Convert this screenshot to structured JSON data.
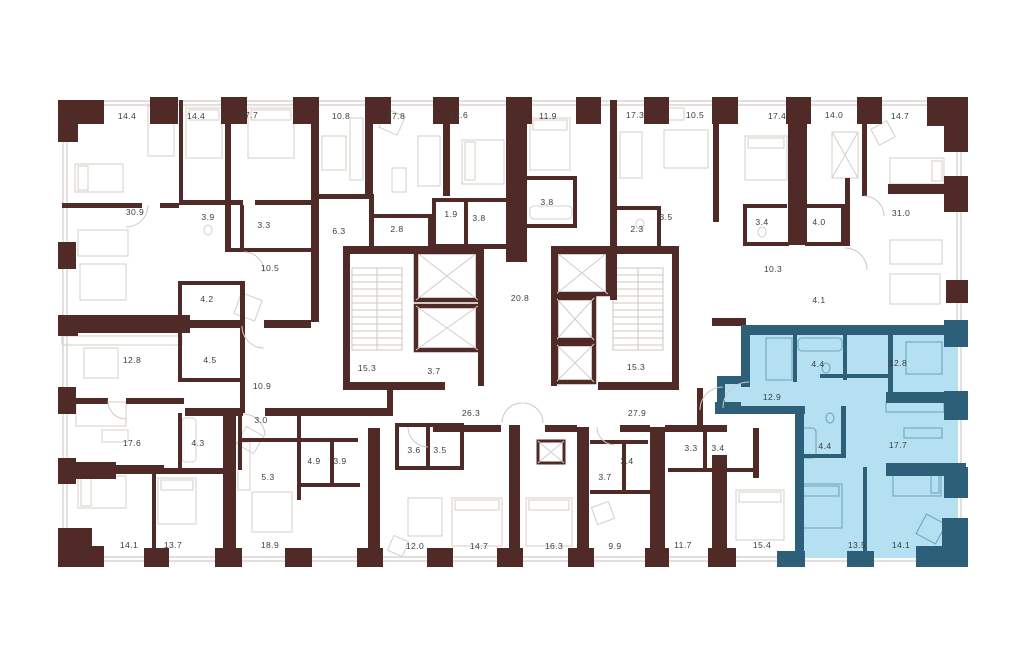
{
  "floorplan": {
    "type": "residential-building-floor-plan",
    "highlighted_unit_selected": true,
    "colors": {
      "wall": "#4f2a27",
      "teal": "#2e5f79",
      "bluefill": "#b5e0f2",
      "line": "#d9d2cb",
      "winline": "#d3ccc6",
      "bline": "#6fa6bf",
      "label": "#3d3d3d",
      "bg": "#ffffff"
    },
    "highlight_room_areas": [
      "12.9",
      "4.4",
      "12.8",
      "4.4",
      "17.7",
      "13.5",
      "14.1"
    ],
    "labels": [
      {
        "t": "14.4",
        "x": 127,
        "y": 119,
        "hl": false
      },
      {
        "t": "14.4",
        "x": 196,
        "y": 119,
        "hl": false
      },
      {
        "t": "17.7",
        "x": 249,
        "y": 118,
        "hl": false
      },
      {
        "t": "10.8",
        "x": 341,
        "y": 119,
        "hl": false
      },
      {
        "t": "17.8",
        "x": 396,
        "y": 119,
        "hl": false
      },
      {
        "t": "12.6",
        "x": 459,
        "y": 118,
        "hl": false
      },
      {
        "t": "11.9",
        "x": 548,
        "y": 119,
        "hl": false
      },
      {
        "t": "17.3",
        "x": 635,
        "y": 118,
        "hl": false
      },
      {
        "t": "10.5",
        "x": 695,
        "y": 118,
        "hl": false
      },
      {
        "t": "17.4",
        "x": 777,
        "y": 119,
        "hl": false
      },
      {
        "t": "14.0",
        "x": 834,
        "y": 118,
        "hl": false
      },
      {
        "t": "14.7",
        "x": 900,
        "y": 119,
        "hl": false
      },
      {
        "t": "30.9",
        "x": 135,
        "y": 215,
        "hl": false
      },
      {
        "t": "3.9",
        "x": 208,
        "y": 220,
        "hl": false
      },
      {
        "t": "3.3",
        "x": 264,
        "y": 228,
        "hl": false
      },
      {
        "t": "6.3",
        "x": 339,
        "y": 234,
        "hl": false
      },
      {
        "t": "2.8",
        "x": 397,
        "y": 232,
        "hl": false
      },
      {
        "t": "1.9",
        "x": 451,
        "y": 217,
        "hl": false
      },
      {
        "t": "3.8",
        "x": 479,
        "y": 221,
        "hl": false
      },
      {
        "t": "3.8",
        "x": 547,
        "y": 205,
        "hl": false
      },
      {
        "t": "2.3",
        "x": 637,
        "y": 232,
        "hl": false
      },
      {
        "t": "3.5",
        "x": 666,
        "y": 220,
        "hl": false
      },
      {
        "t": "3.4",
        "x": 762,
        "y": 225,
        "hl": false
      },
      {
        "t": "4.0",
        "x": 819,
        "y": 225,
        "hl": false
      },
      {
        "t": "31.0",
        "x": 901,
        "y": 216,
        "hl": false
      },
      {
        "t": "10.5",
        "x": 270,
        "y": 271,
        "hl": false
      },
      {
        "t": "10.3",
        "x": 773,
        "y": 272,
        "hl": false
      },
      {
        "t": "4.2",
        "x": 207,
        "y": 302,
        "hl": false
      },
      {
        "t": "12.8",
        "x": 132,
        "y": 363,
        "hl": false
      },
      {
        "t": "4.5",
        "x": 210,
        "y": 363,
        "hl": false
      },
      {
        "t": "10.9",
        "x": 262,
        "y": 389,
        "hl": false
      },
      {
        "t": "15.3",
        "x": 367,
        "y": 371,
        "hl": false
      },
      {
        "t": "3.7",
        "x": 434,
        "y": 374,
        "hl": false
      },
      {
        "t": "20.8",
        "x": 520,
        "y": 301,
        "hl": false
      },
      {
        "t": "15.3",
        "x": 636,
        "y": 370,
        "hl": false
      },
      {
        "t": "4.1",
        "x": 819,
        "y": 303,
        "hl": false
      },
      {
        "t": "26.3",
        "x": 471,
        "y": 416,
        "hl": false
      },
      {
        "t": "27.9",
        "x": 637,
        "y": 416,
        "hl": false
      },
      {
        "t": "12.9",
        "x": 772,
        "y": 400,
        "hl": true
      },
      {
        "t": "4.4",
        "x": 818,
        "y": 367,
        "hl": true
      },
      {
        "t": "12.8",
        "x": 898,
        "y": 366,
        "hl": true
      },
      {
        "t": "4.4",
        "x": 825,
        "y": 449,
        "hl": true
      },
      {
        "t": "17.7",
        "x": 898,
        "y": 448,
        "hl": true
      },
      {
        "t": "13.5",
        "x": 857,
        "y": 548,
        "hl": true
      },
      {
        "t": "14.1",
        "x": 901,
        "y": 548,
        "hl": true
      },
      {
        "t": "17.6",
        "x": 132,
        "y": 446,
        "hl": false
      },
      {
        "t": "4.3",
        "x": 198,
        "y": 446,
        "hl": false
      },
      {
        "t": "3.0",
        "x": 261,
        "y": 423,
        "hl": false
      },
      {
        "t": "5.3",
        "x": 268,
        "y": 480,
        "hl": false
      },
      {
        "t": "4.9",
        "x": 314,
        "y": 464,
        "hl": false
      },
      {
        "t": "3.9",
        "x": 340,
        "y": 464,
        "hl": false
      },
      {
        "t": "3.6",
        "x": 414,
        "y": 453,
        "hl": false
      },
      {
        "t": "3.5",
        "x": 440,
        "y": 453,
        "hl": false
      },
      {
        "t": "3.4",
        "x": 627,
        "y": 464,
        "hl": false
      },
      {
        "t": "3.7",
        "x": 605,
        "y": 480,
        "hl": false
      },
      {
        "t": "3.3",
        "x": 691,
        "y": 451,
        "hl": false
      },
      {
        "t": "3.4",
        "x": 718,
        "y": 451,
        "hl": false
      },
      {
        "t": "14.1",
        "x": 129,
        "y": 548,
        "hl": false
      },
      {
        "t": "13.7",
        "x": 173,
        "y": 548,
        "hl": false
      },
      {
        "t": "18.9",
        "x": 270,
        "y": 548,
        "hl": false
      },
      {
        "t": "12.0",
        "x": 415,
        "y": 549,
        "hl": false
      },
      {
        "t": "14.7",
        "x": 479,
        "y": 549,
        "hl": false
      },
      {
        "t": "16.3",
        "x": 554,
        "y": 549,
        "hl": false
      },
      {
        "t": "9.9",
        "x": 615,
        "y": 549,
        "hl": false
      },
      {
        "t": "11.7",
        "x": 683,
        "y": 548,
        "hl": false
      },
      {
        "t": "15.4",
        "x": 762,
        "y": 548,
        "hl": false
      }
    ]
  }
}
